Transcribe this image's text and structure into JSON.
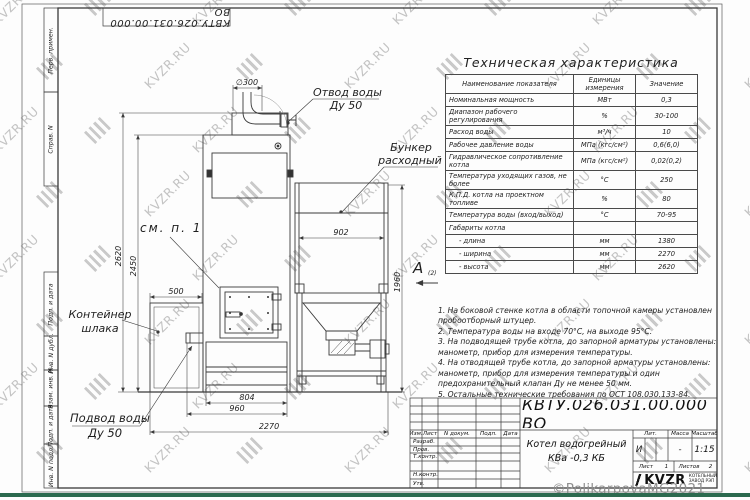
{
  "watermark": {
    "text": "KVZR.RU",
    "copyright": "©PolikarpovaMG2021"
  },
  "margin_labels": {
    "perv_primen": "Перв. примен.",
    "sprav_n": "Справ. N",
    "podp_data1": "Подп. и дата",
    "inv_dubl": "Инв. N дубл.",
    "vzam_inv": "Взам. инв. N",
    "podp_data2": "Подп. и дата",
    "inv_podl": "Инв. N подл."
  },
  "top_stamp": {
    "doc_number": "КВТУ.026.031.00.000 ВО"
  },
  "spec_table": {
    "title": "Техническая характеристика",
    "columns": [
      "Наименование показателя",
      "Единицы измерения",
      "Значение"
    ],
    "rows": [
      [
        "Номинальная мощность",
        "МВт",
        "0,3"
      ],
      [
        "Диапазон рабочего регулирования",
        "%",
        "30-100"
      ],
      [
        "Расход воды",
        "м³/ч",
        "10"
      ],
      [
        "Рабочее давление воды",
        "МПа (кгс/см²)",
        "0,6(6,0)"
      ],
      [
        "Гидравлическое сопротивление котла",
        "МПа (кгс/см²)",
        "0,02(0,2)"
      ],
      [
        "Температура уходящих газов, не более",
        "°С",
        "250"
      ],
      [
        "К.П.Д. котла на проектном топливе",
        "%",
        "80"
      ],
      [
        "Температура воды (вход/выход)",
        "°С",
        "70-95"
      ],
      [
        "Габариты котла",
        "",
        ""
      ],
      [
        "- длина",
        "мм",
        "1380"
      ],
      [
        "- ширина",
        "мм",
        "2270"
      ],
      [
        "- высота",
        "мм",
        "2620"
      ]
    ]
  },
  "notes": [
    "1. На боковой стенке котла в области топочной камеры установлен пробоотборный штуцер.",
    "2. Температура воды на входе 70°С, на выходе 95°С.",
    "3. На подводящей трубе котла, до запорной арматуры установлены: манометр, прибор для измерения температуры.",
    "4. На отводящей трубе котла, до запорной арматуры установлены: манометр, прибор для измерения температуры и один предохранительный клапан Ду не менее 50 мм.",
    "5. Остальные технические требования по ОСТ 108.030.133-84."
  ],
  "drawing": {
    "labels": {
      "outlet_1": "Отвод воды",
      "outlet_2": "Ду 50",
      "bunker_1": "Бункер",
      "bunker_2": "расходный",
      "see_note": "см. п. 1",
      "container_1": "Контейнер",
      "container_2": "шлака",
      "inlet_1": "Подвод воды",
      "inlet_2": "Ду 50",
      "view": "А",
      "view_sheet": "(2)"
    },
    "dims": {
      "d300": "∅300",
      "d2620": "2620",
      "d2450": "2450",
      "d500": "500",
      "d804": "804",
      "d960": "960",
      "d2270": "2270",
      "d902": "902",
      "d1960": "1960"
    }
  },
  "title_block": {
    "doc_number": "КВТУ.026.031.00.000 ВО",
    "product_line1": "Котел водогрейный",
    "product_line2": "КВа -0,3 КБ",
    "header": {
      "izm": "Изм.",
      "list": "Лист",
      "ndoc": "N докум.",
      "podp": "Подп.",
      "date": "Дата"
    },
    "rows": {
      "razrab": "Разраб.",
      "prov": "Пров.",
      "tkontr": "Т.контр.",
      "nkontr": "Н.контр.",
      "utv": "Утв."
    },
    "lit_label": "Лит.",
    "massa_label": "Масса",
    "scale_label": "Масштаб",
    "lit_value": "И",
    "massa_value": "-",
    "scale_value": "1:15",
    "sheet_label": "Лист",
    "sheet_value": "1",
    "sheets_label": "Листов",
    "sheets_value": "2",
    "logo_text": "KVZR",
    "logo_sub1": "КОТЕЛЬНЫЙ",
    "logo_sub2": "ЗАВОД РЭП"
  }
}
